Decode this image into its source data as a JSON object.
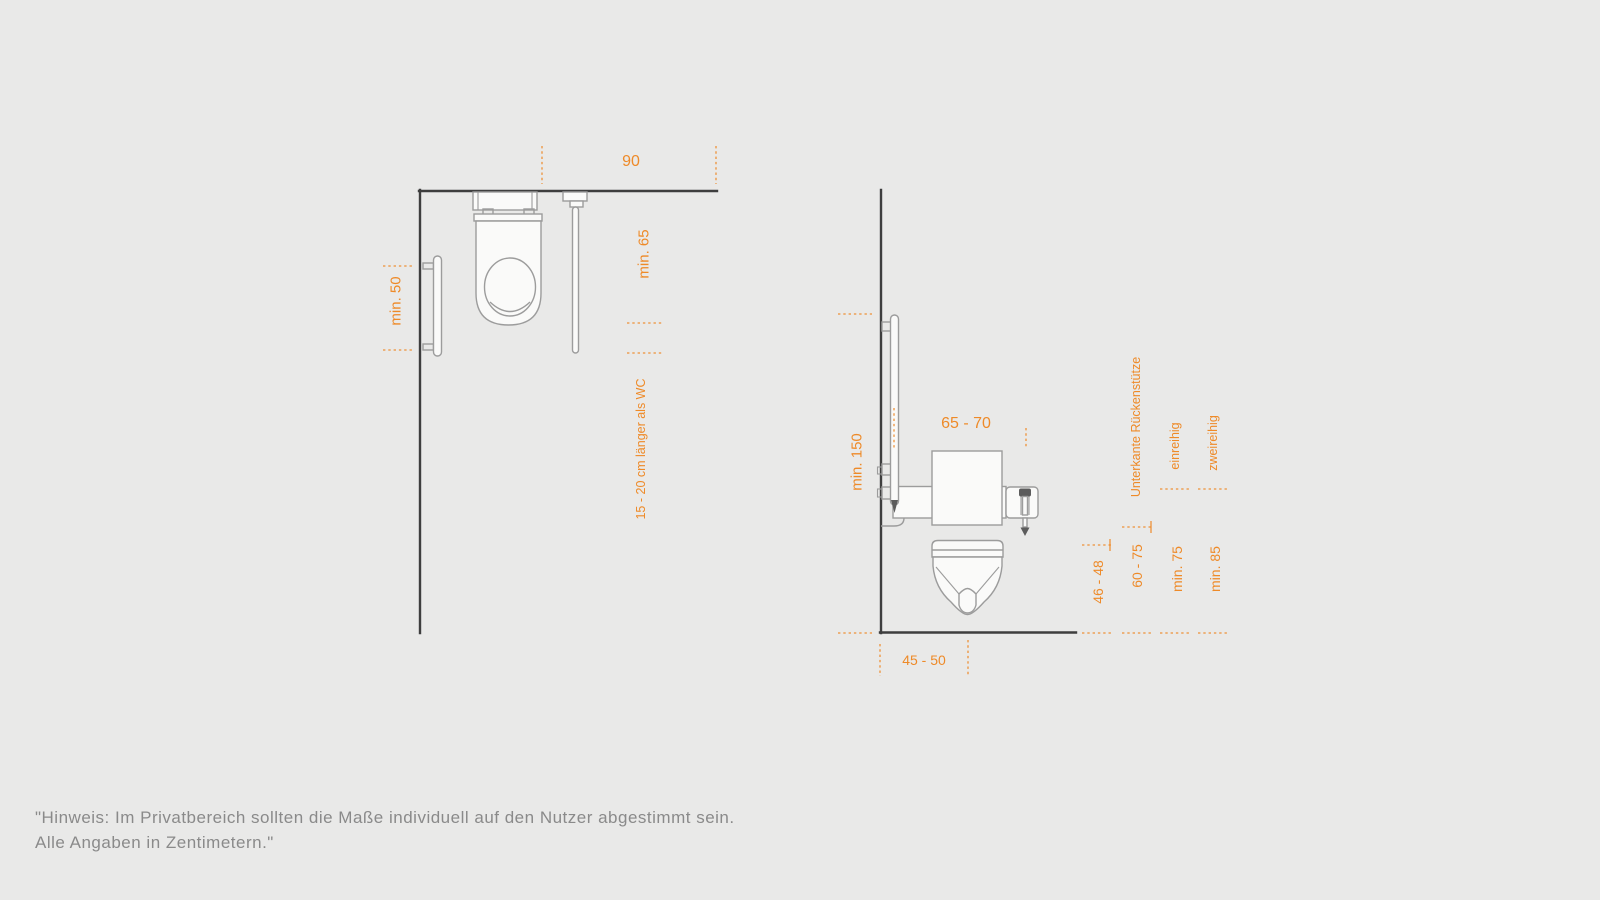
{
  "colors": {
    "background": "#e9e9e8",
    "accent_orange": "#ee8a28",
    "wall_line": "#3e3e3e",
    "fixture_line": "#9c9c9c",
    "note_text": "#8a8a8a"
  },
  "top_view": {
    "dim_width_90": "90",
    "dim_depth_min_65": "min. 65",
    "dim_grab_bar_min_50": "min. 50",
    "dim_rail_longer": "15 - 20 cm länger als WC"
  },
  "side_view": {
    "dim_height_min_150": "min. 150",
    "dim_rail_length_65_70": "65 - 70",
    "dim_depth_45_50": "45 - 50",
    "dim_seat_height_46_48": "46 - 48",
    "dim_backrest_60_75": "60 - 75",
    "dim_single_row_min_75": "min. 75",
    "dim_double_row_min_85": "min. 85",
    "label_backrest": "Unterkante Rückenstütze",
    "label_single_row": "einreihig",
    "label_double_row": "zweireihig"
  },
  "note": {
    "line1": "\"Hinweis: Im Privatbereich sollten die Maße individuell auf den Nutzer abgestimmt sein.",
    "line2": "Alle Angaben in Zentimetern.\""
  }
}
